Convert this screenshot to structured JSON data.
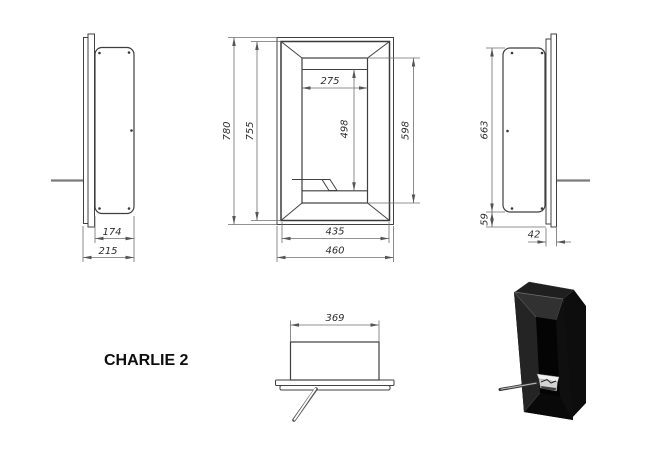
{
  "title": "CHARLIE 2",
  "drawing": {
    "front_view": {
      "overall_height": "780",
      "frame_height": "755",
      "opening_width": "275",
      "opening_height": "498",
      "inner_frame_height": "598",
      "frame_width": "435",
      "overall_width": "460"
    },
    "side_view_left": {
      "body_depth": "174",
      "overall_depth": "215"
    },
    "side_view_right": {
      "body_height": "663",
      "bottom_offset": "59",
      "flange_depth": "42"
    },
    "top_view": {
      "burner_box_width": "369"
    }
  },
  "colors": {
    "background": "#ffffff",
    "drawing_line": "#424242",
    "dimension_line": "#6e6e6e",
    "dimension_text": "#2d2d2d",
    "product_black": "#141414",
    "burner_silver": "#e8e8e8"
  }
}
